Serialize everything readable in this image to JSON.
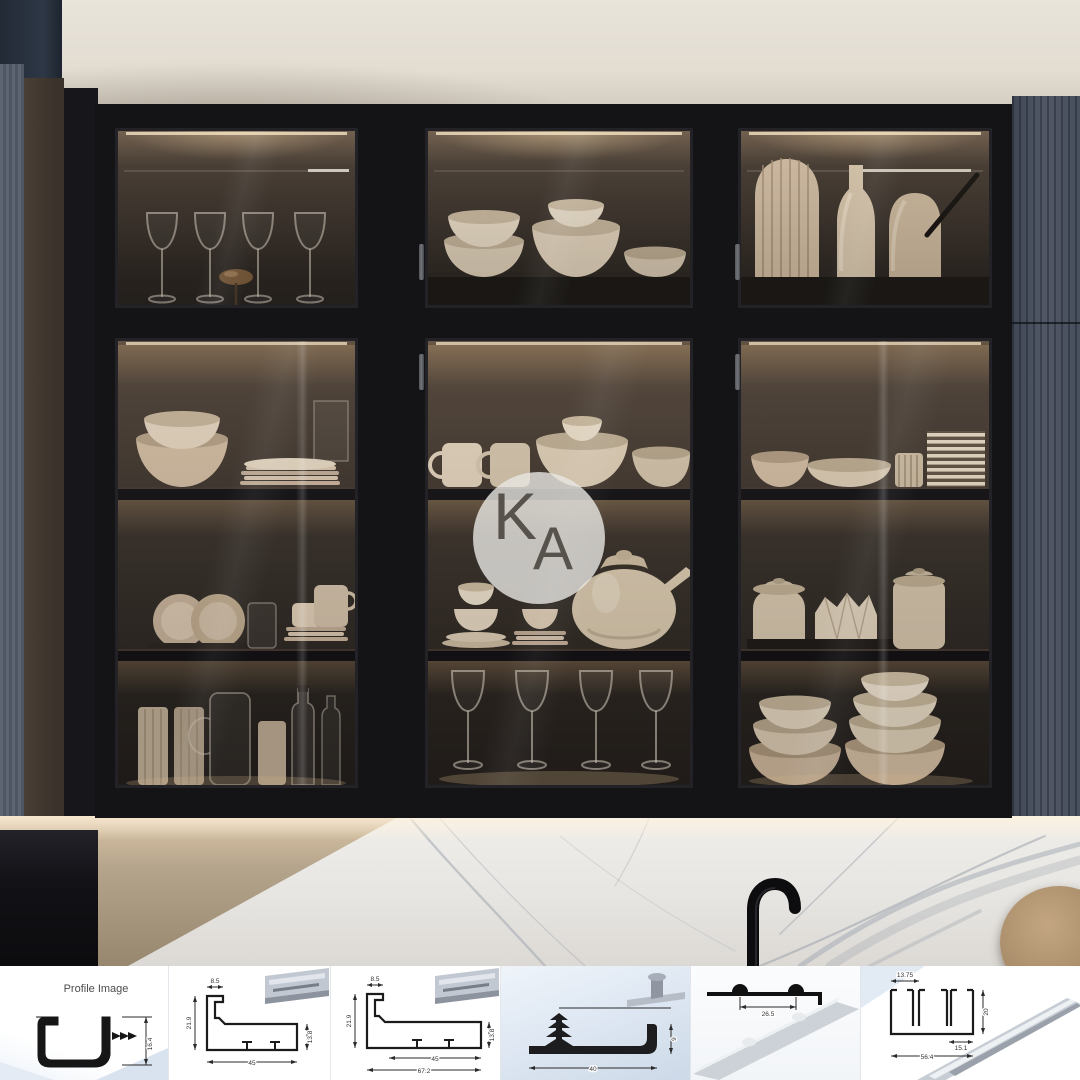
{
  "watermark": {
    "k": "K",
    "a": "A"
  },
  "profile_strip": {
    "panels": [
      {
        "name": "c-channel-profile",
        "title": "Profile Image",
        "dims": {
          "height": "16.4"
        }
      },
      {
        "name": "frame-profile-45",
        "dims": {
          "top": "8.5",
          "left": "21.9",
          "right": "13.8",
          "bottom": "45"
        }
      },
      {
        "name": "frame-profile-67",
        "dims": {
          "top": "8.5",
          "left": "21.9",
          "right": "13.8",
          "bottom_inner": "45",
          "bottom_outer": "67.2"
        }
      },
      {
        "name": "l-gasket-profile",
        "dims": {
          "right": "9",
          "bottom": "40"
        }
      },
      {
        "name": "bump-track-profile",
        "dims": {
          "width": "26.5"
        }
      },
      {
        "name": "double-track-profile",
        "dims": {
          "top": "13.75",
          "right": "20",
          "inner": "15.1",
          "bottom": "56.4"
        }
      }
    ]
  },
  "colors": {
    "cabinet_black": "#141316",
    "navy_panel": "#47505f",
    "ceiling": "#e2dcd1",
    "dishware_beige": "#c9b39a",
    "marble_vein": "#9aa2ac",
    "accent_blue": "#dbe6f1",
    "glow_warm": "#e8cfa4"
  }
}
